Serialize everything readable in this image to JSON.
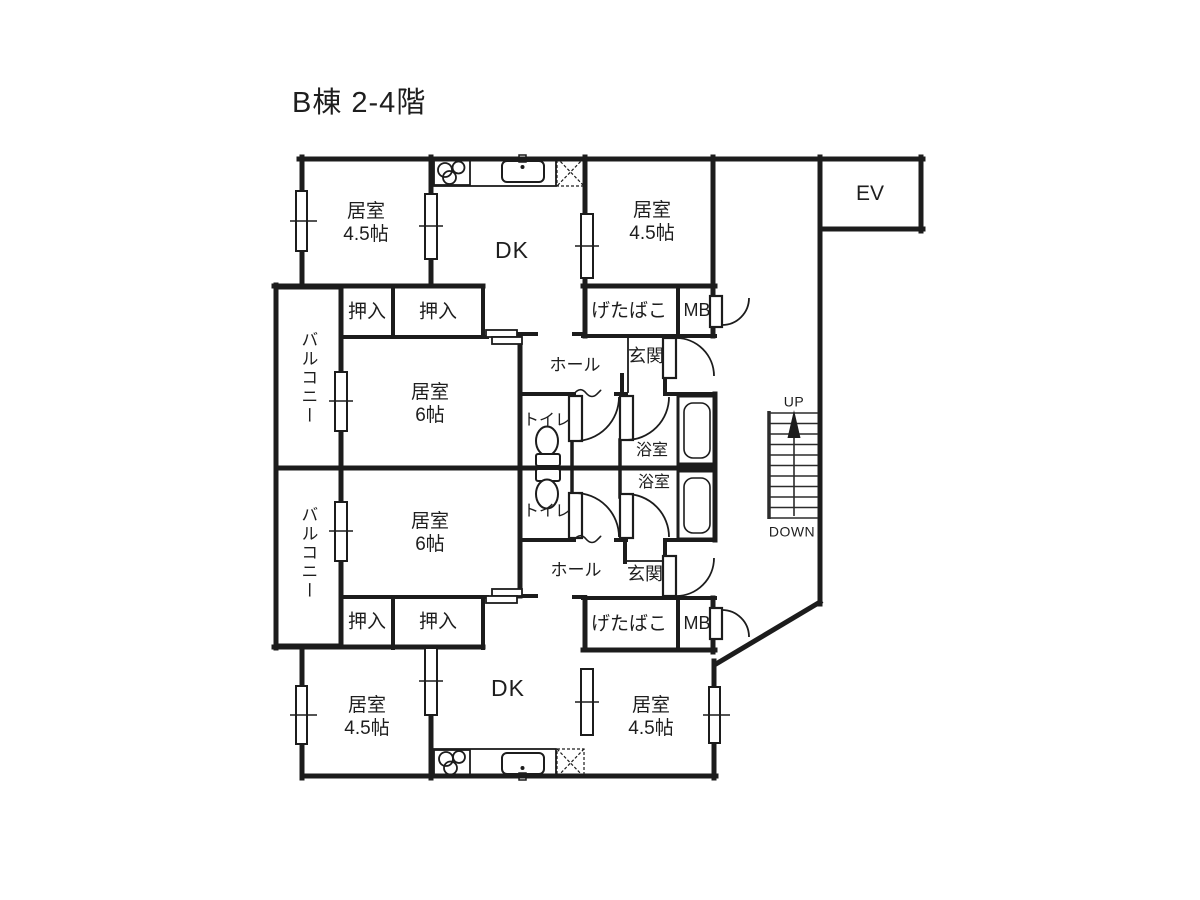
{
  "title": "B棟 2-4階",
  "labels": {
    "room": "居室",
    "size_45": "4.5帖",
    "size_6": "6帖",
    "dk": "DK",
    "closet": "押入",
    "balcony": "バルコニー",
    "shoe_box": "げたばこ",
    "meter_box": "MB",
    "entrance": "玄関",
    "hall": "ホール",
    "toilet": "トイレ",
    "bathroom": "浴室",
    "elevator": "EV",
    "stairs_up": "UP",
    "stairs_down": "DOWN"
  },
  "colors": {
    "wall": "#1c1c1c",
    "background": "#ffffff"
  }
}
